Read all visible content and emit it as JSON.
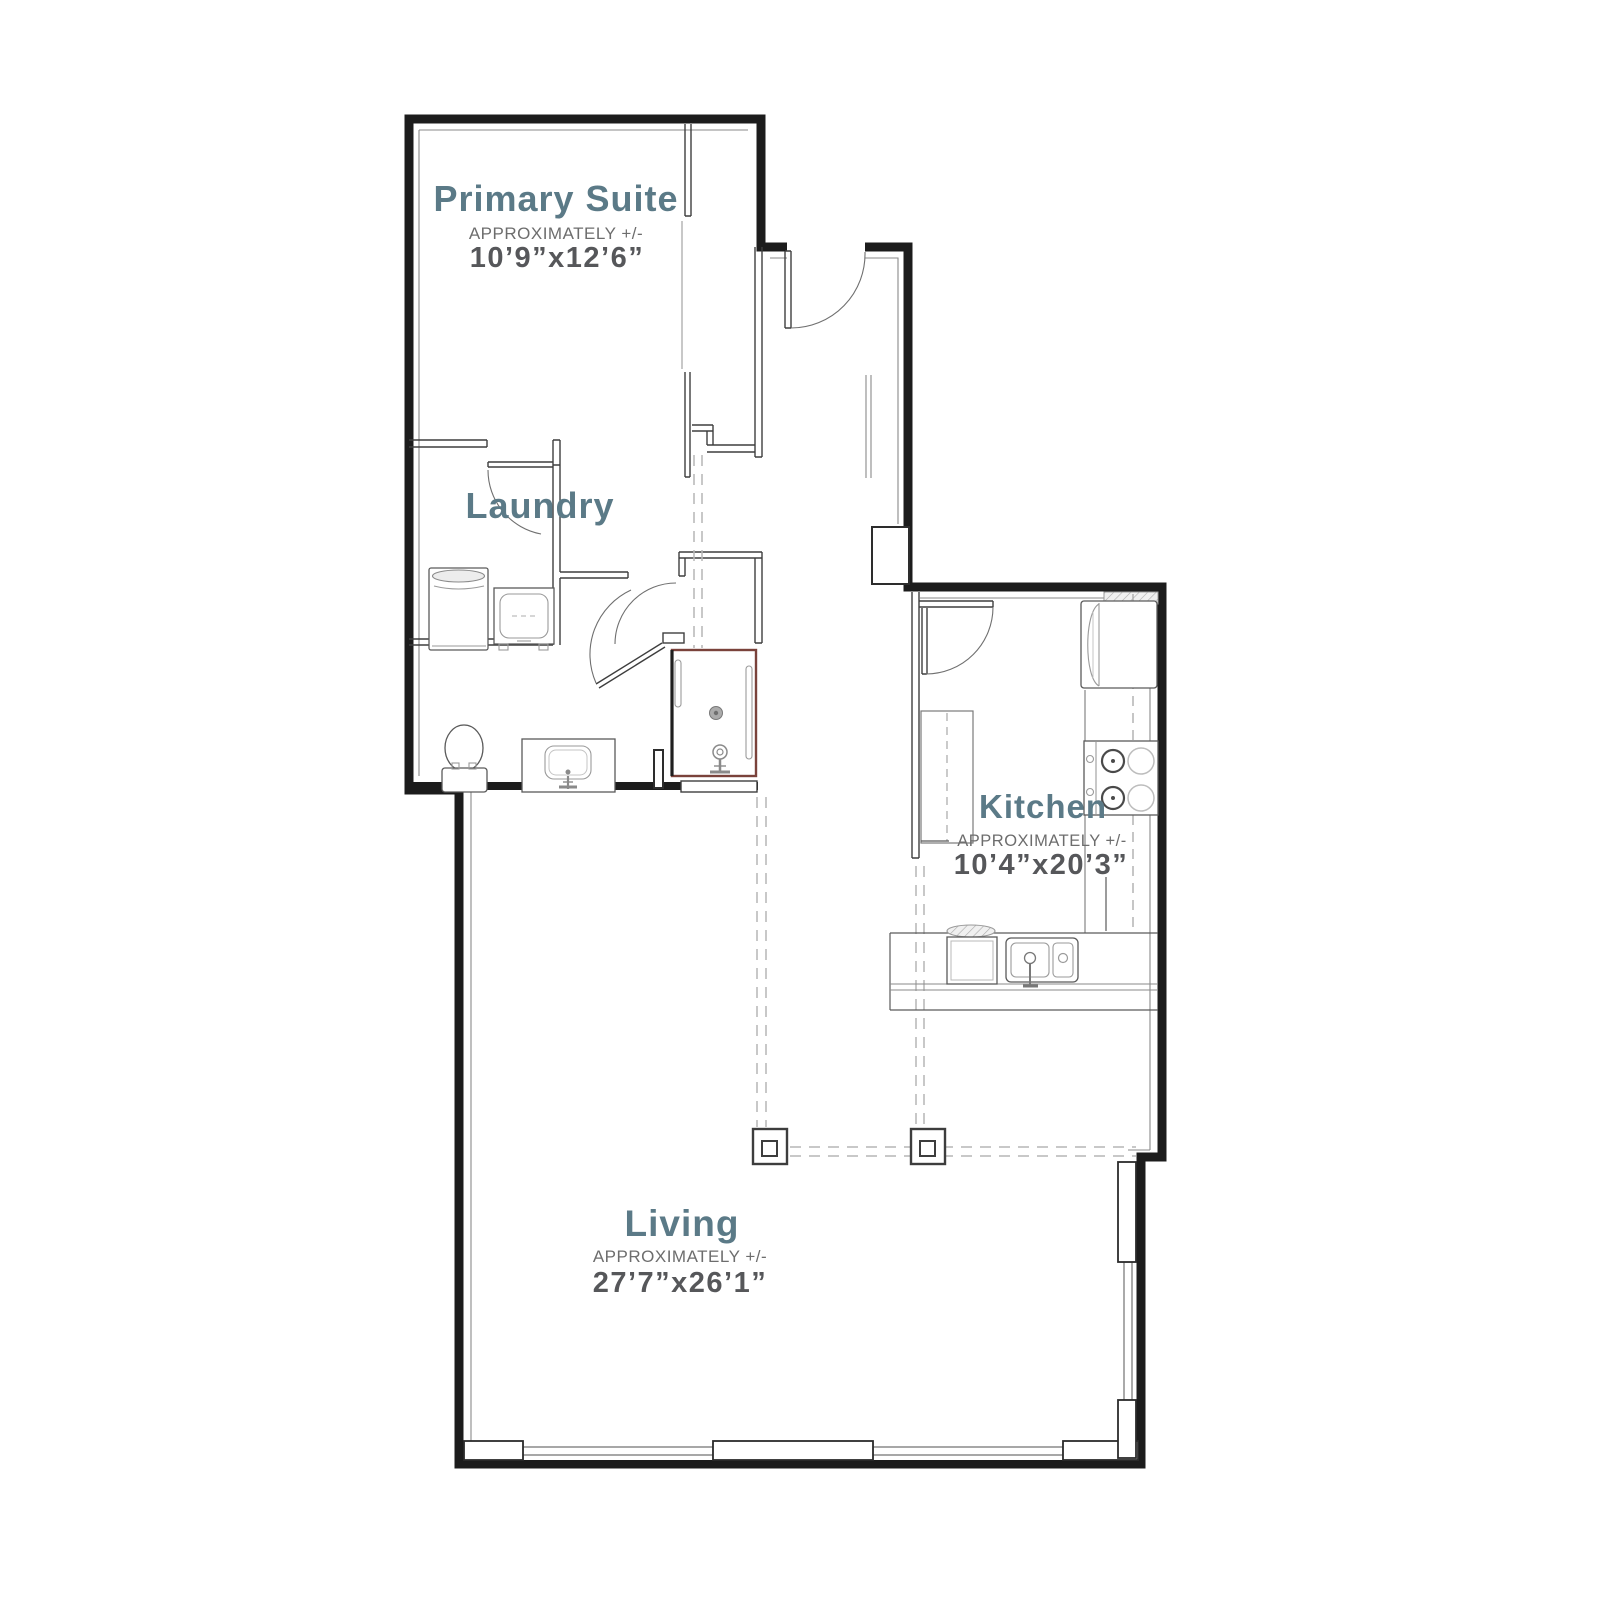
{
  "plan": {
    "rooms": [
      {
        "id": "primary-suite",
        "name": "Primary Suite",
        "approx": "APPROXIMATELY +/-",
        "dims": "10’9”x12’6”"
      },
      {
        "id": "laundry",
        "name": "Laundry",
        "approx": "",
        "dims": ""
      },
      {
        "id": "kitchen",
        "name": "Kitchen",
        "approx": "APPROXIMATELY +/-",
        "dims": "10’4”x20’3”"
      },
      {
        "id": "living",
        "name": "Living",
        "approx": "APPROXIMATELY +/-",
        "dims": "27’7”x26’1”"
      }
    ],
    "colors": {
      "room_label": "#5b7a87",
      "approx_text": "#6d6d6d",
      "dims_text": "#56575a",
      "wall": "#1c1c1c",
      "interior_wall": "#3e3e3e",
      "shower_accent": "#7a423b",
      "grid_dash": "#b6b6b6",
      "window": "#9b9b9b"
    },
    "fixtures": [
      "washer",
      "dryer",
      "toilet",
      "vanity-sink",
      "shower",
      "refrigerator",
      "pantry-cabinet",
      "range",
      "dishwasher",
      "kitchen-sink",
      "structural-column",
      "structural-column"
    ]
  }
}
